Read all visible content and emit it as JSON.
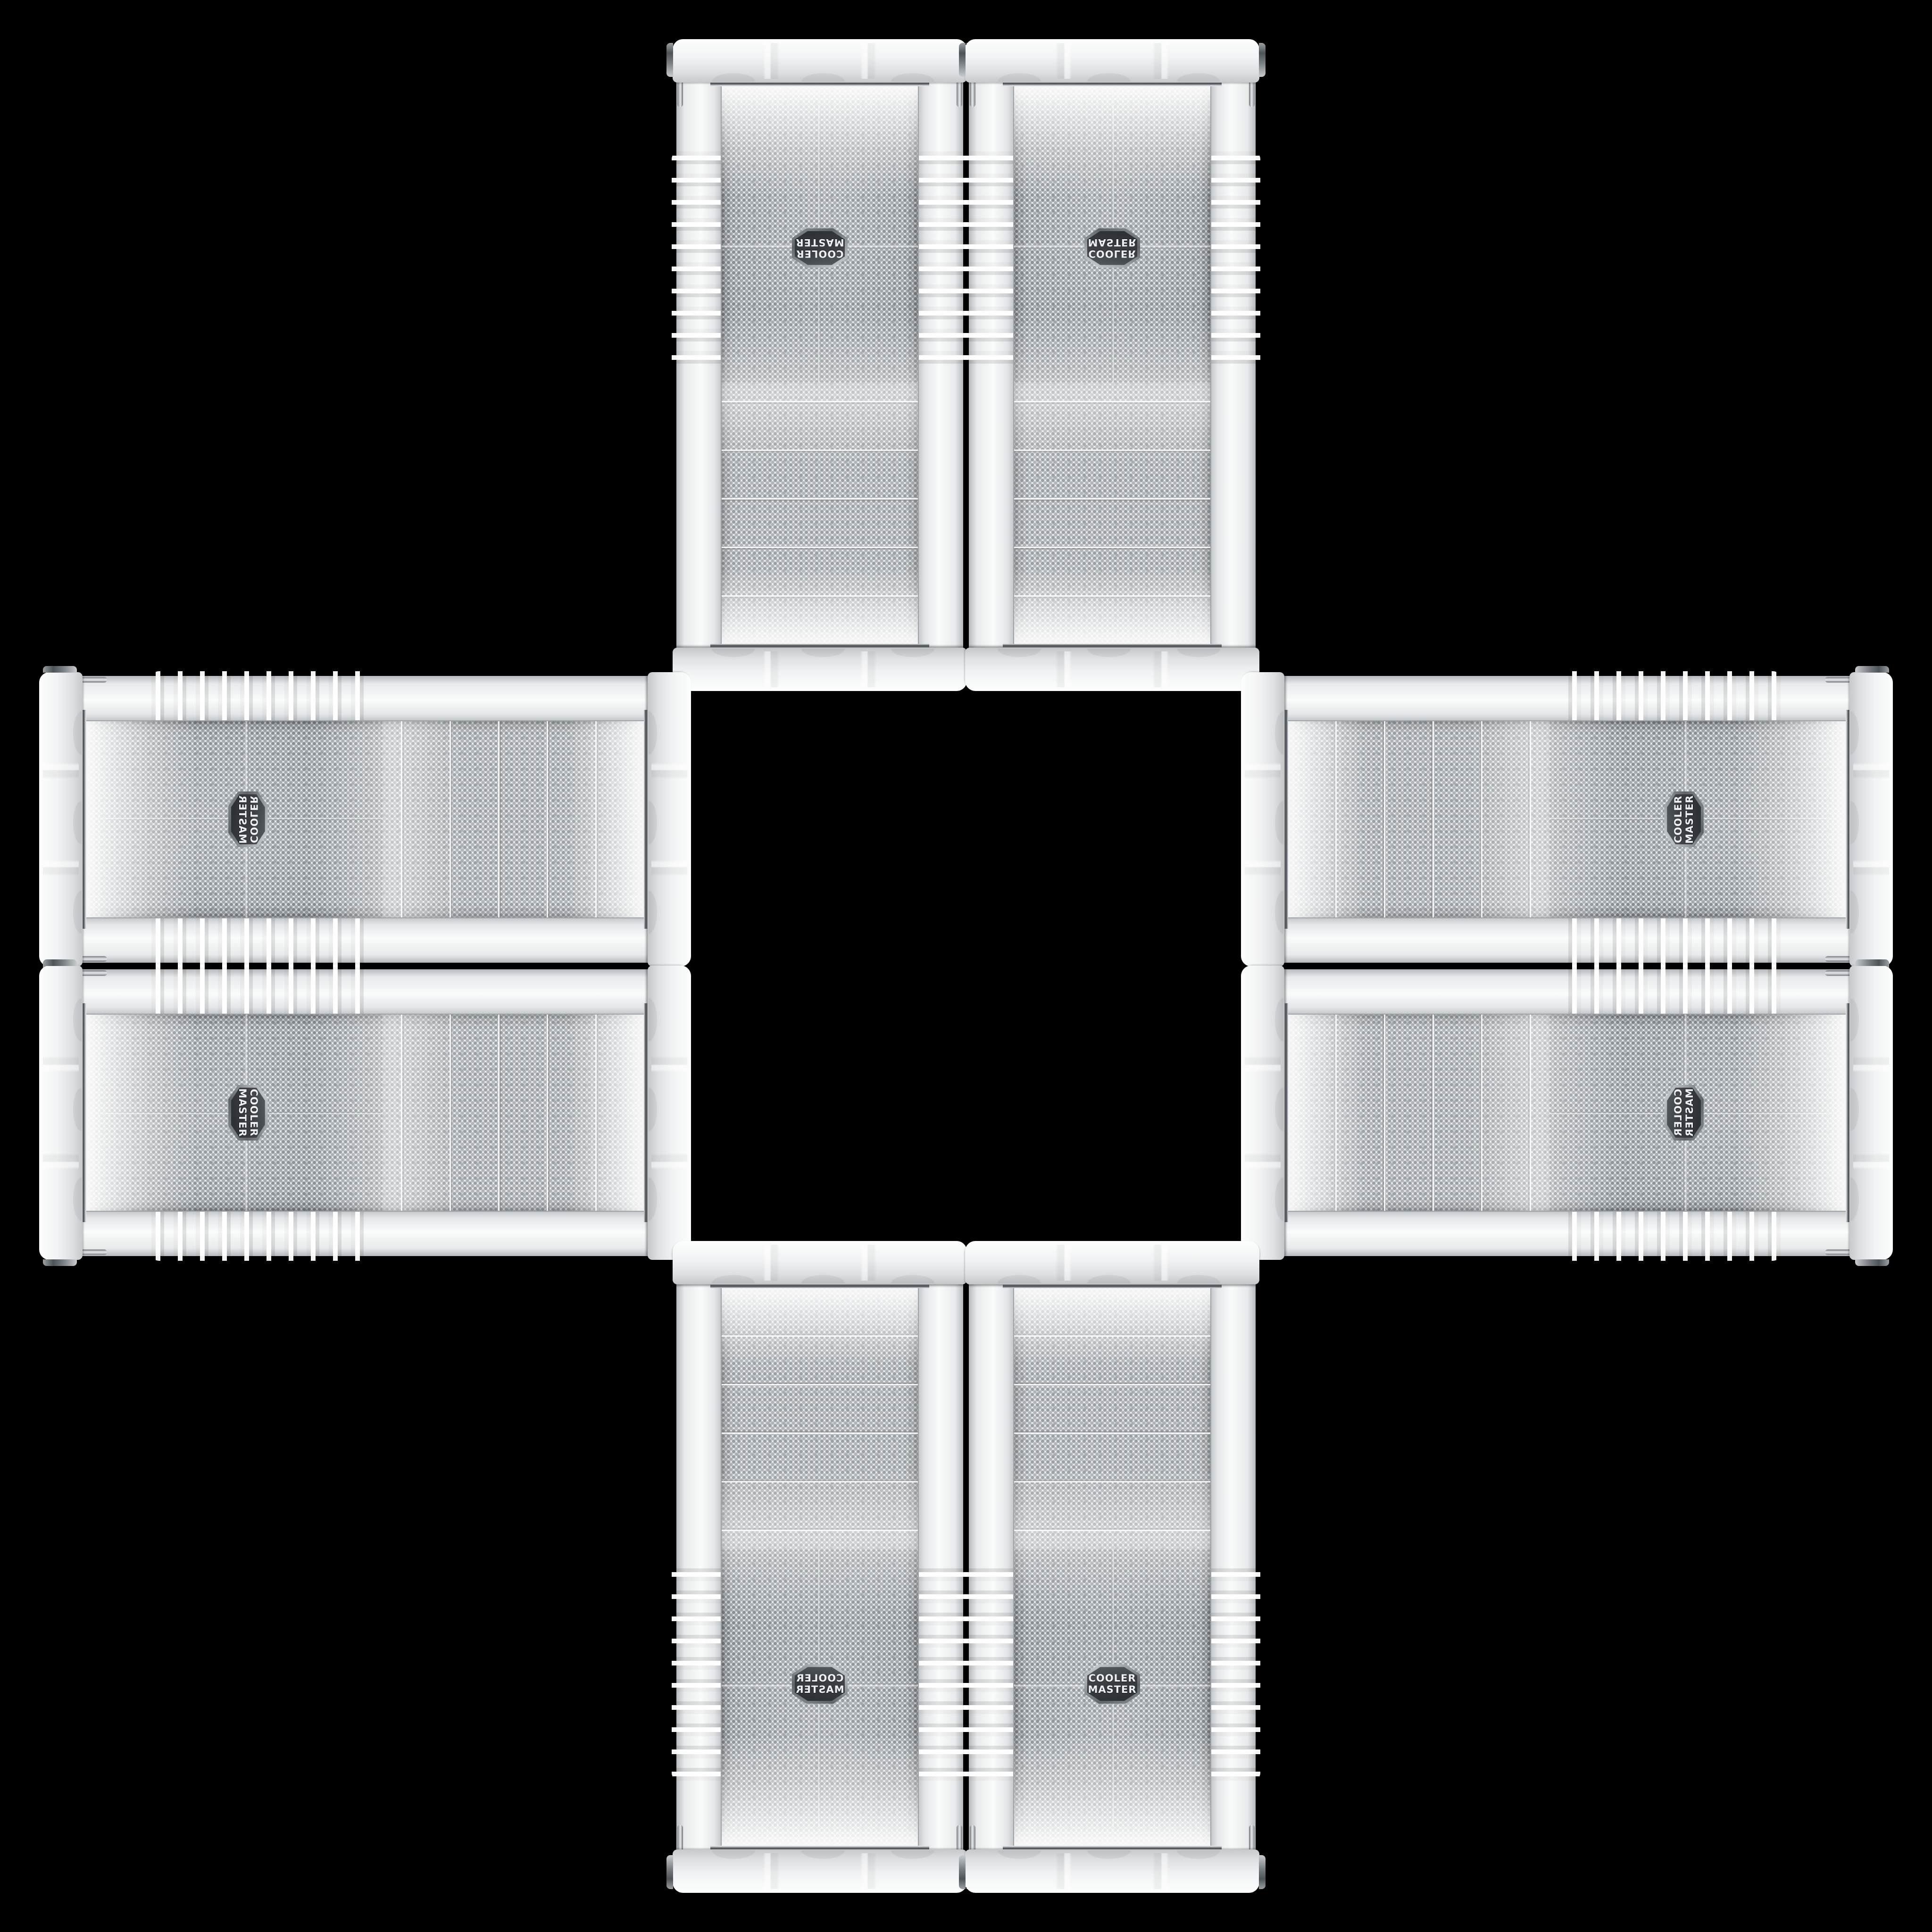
{
  "scene": {
    "description": "Eight identical white Cooler Master mid-tower PC case fronts arranged in a plus / cross pattern on a black background, mirrored and rotated copies of one product photo",
    "background_color": "#000000",
    "case_count": 8,
    "brand": "Cooler Master"
  },
  "badge": {
    "line1": "COOLER",
    "line2": "MASTER"
  },
  "colors": {
    "case_body": "#eceeef",
    "mesh_background": "#e7e9eb",
    "mesh_dot": "#7c8388",
    "chrome_dark": "#4b5156",
    "badge_face": "#3a3e42",
    "badge_text": "#eef0f1"
  },
  "cases": [
    {
      "id": "top-left",
      "orientation": "vertical tower, rotated 180°"
    },
    {
      "id": "top-right",
      "orientation": "vertical tower, flipped vertically"
    },
    {
      "id": "left-top",
      "orientation": "horizontal, rotated -90° and mirrored"
    },
    {
      "id": "right-top",
      "orientation": "horizontal, rotated -90°"
    },
    {
      "id": "left-bottom",
      "orientation": "horizontal, rotated 90°"
    },
    {
      "id": "right-bottom",
      "orientation": "horizontal, rotated -90° and flipped"
    },
    {
      "id": "bottom-left",
      "orientation": "vertical tower, mirrored horizontally"
    },
    {
      "id": "bottom-right",
      "orientation": "vertical tower, upright"
    }
  ]
}
